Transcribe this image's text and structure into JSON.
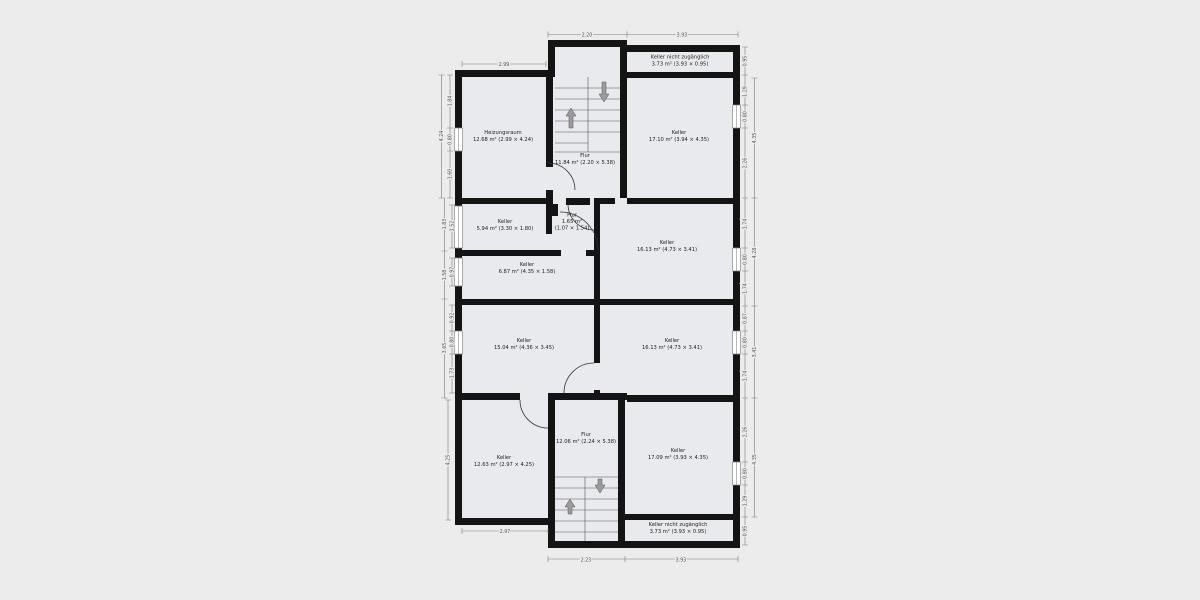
{
  "colors": {
    "background": "#ececec",
    "room_fill": "#e9eaee",
    "wall": "#141414",
    "dimension_text": "#555555",
    "stair_arrow": "#9b9b9b"
  },
  "rooms": [
    {
      "id": "heizungsraum",
      "name": "Heizungsraum",
      "area": "12.68 m² (2.99 × 4.24)"
    },
    {
      "id": "flur-upper",
      "name": "Flur",
      "area": "11.84 m² (2.20 × 5.38)"
    },
    {
      "id": "keller-na-top",
      "name": "Keller nicht zugänglich",
      "area": "3.73 m² (3.93 × 0.95)"
    },
    {
      "id": "keller-top-right",
      "name": "Keller",
      "area": "17.10 m² (3.94 × 4.35)"
    },
    {
      "id": "keller-mid-small",
      "name": "Keller",
      "area": "5.94 m² (3.30 × 1.80)"
    },
    {
      "id": "flur-tiny",
      "name": "Flur",
      "area": "1.65 m²",
      "dims": "(1.07 × 1.54)"
    },
    {
      "id": "keller-mid-right",
      "name": "Keller",
      "area": "16.13 m² (4.73 × 3.41)"
    },
    {
      "id": "keller-687",
      "name": "Keller",
      "area": "6.87 m² (4.35 × 1.58)"
    },
    {
      "id": "keller-1504",
      "name": "Keller",
      "area": "15.04 m² (4.36 × 3.45)"
    },
    {
      "id": "keller-low-right",
      "name": "Keller",
      "area": "16.13 m² (4.73 × 3.41)"
    },
    {
      "id": "keller-1263",
      "name": "Keller",
      "area": "12.63 m² (2.97 × 4.25)"
    },
    {
      "id": "flur-lower",
      "name": "Flur",
      "area": "12.06 m² (2.24 × 5.38)"
    },
    {
      "id": "keller-bottom-right",
      "name": "Keller",
      "area": "17.09 m² (3.93 × 4.35)"
    },
    {
      "id": "keller-na-bottom",
      "name": "Keller nicht zugänglich",
      "area": "3.73 m² (3.93 × 0.95)"
    }
  ],
  "dims": {
    "top": [
      "2.99",
      "2.20",
      "3.93"
    ],
    "bottom": [
      "2.97",
      "2.23",
      "3.93"
    ],
    "left": [
      "4.24",
      "1.84",
      "0.80",
      "1.60",
      "1.83",
      "1.52",
      "1.58",
      "0.97",
      "3.65",
      "0.92",
      "0.80",
      "1.73",
      "4.25"
    ],
    "right": [
      "0.95",
      "1.29",
      "0.80",
      "2.26",
      "4.35",
      "1.74",
      "0.80",
      "1.74",
      "4.28",
      "0.87",
      "0.80",
      "1.74",
      "3.41",
      "2.26",
      "0.80",
      "1.29",
      "4.35",
      "0.95"
    ]
  }
}
